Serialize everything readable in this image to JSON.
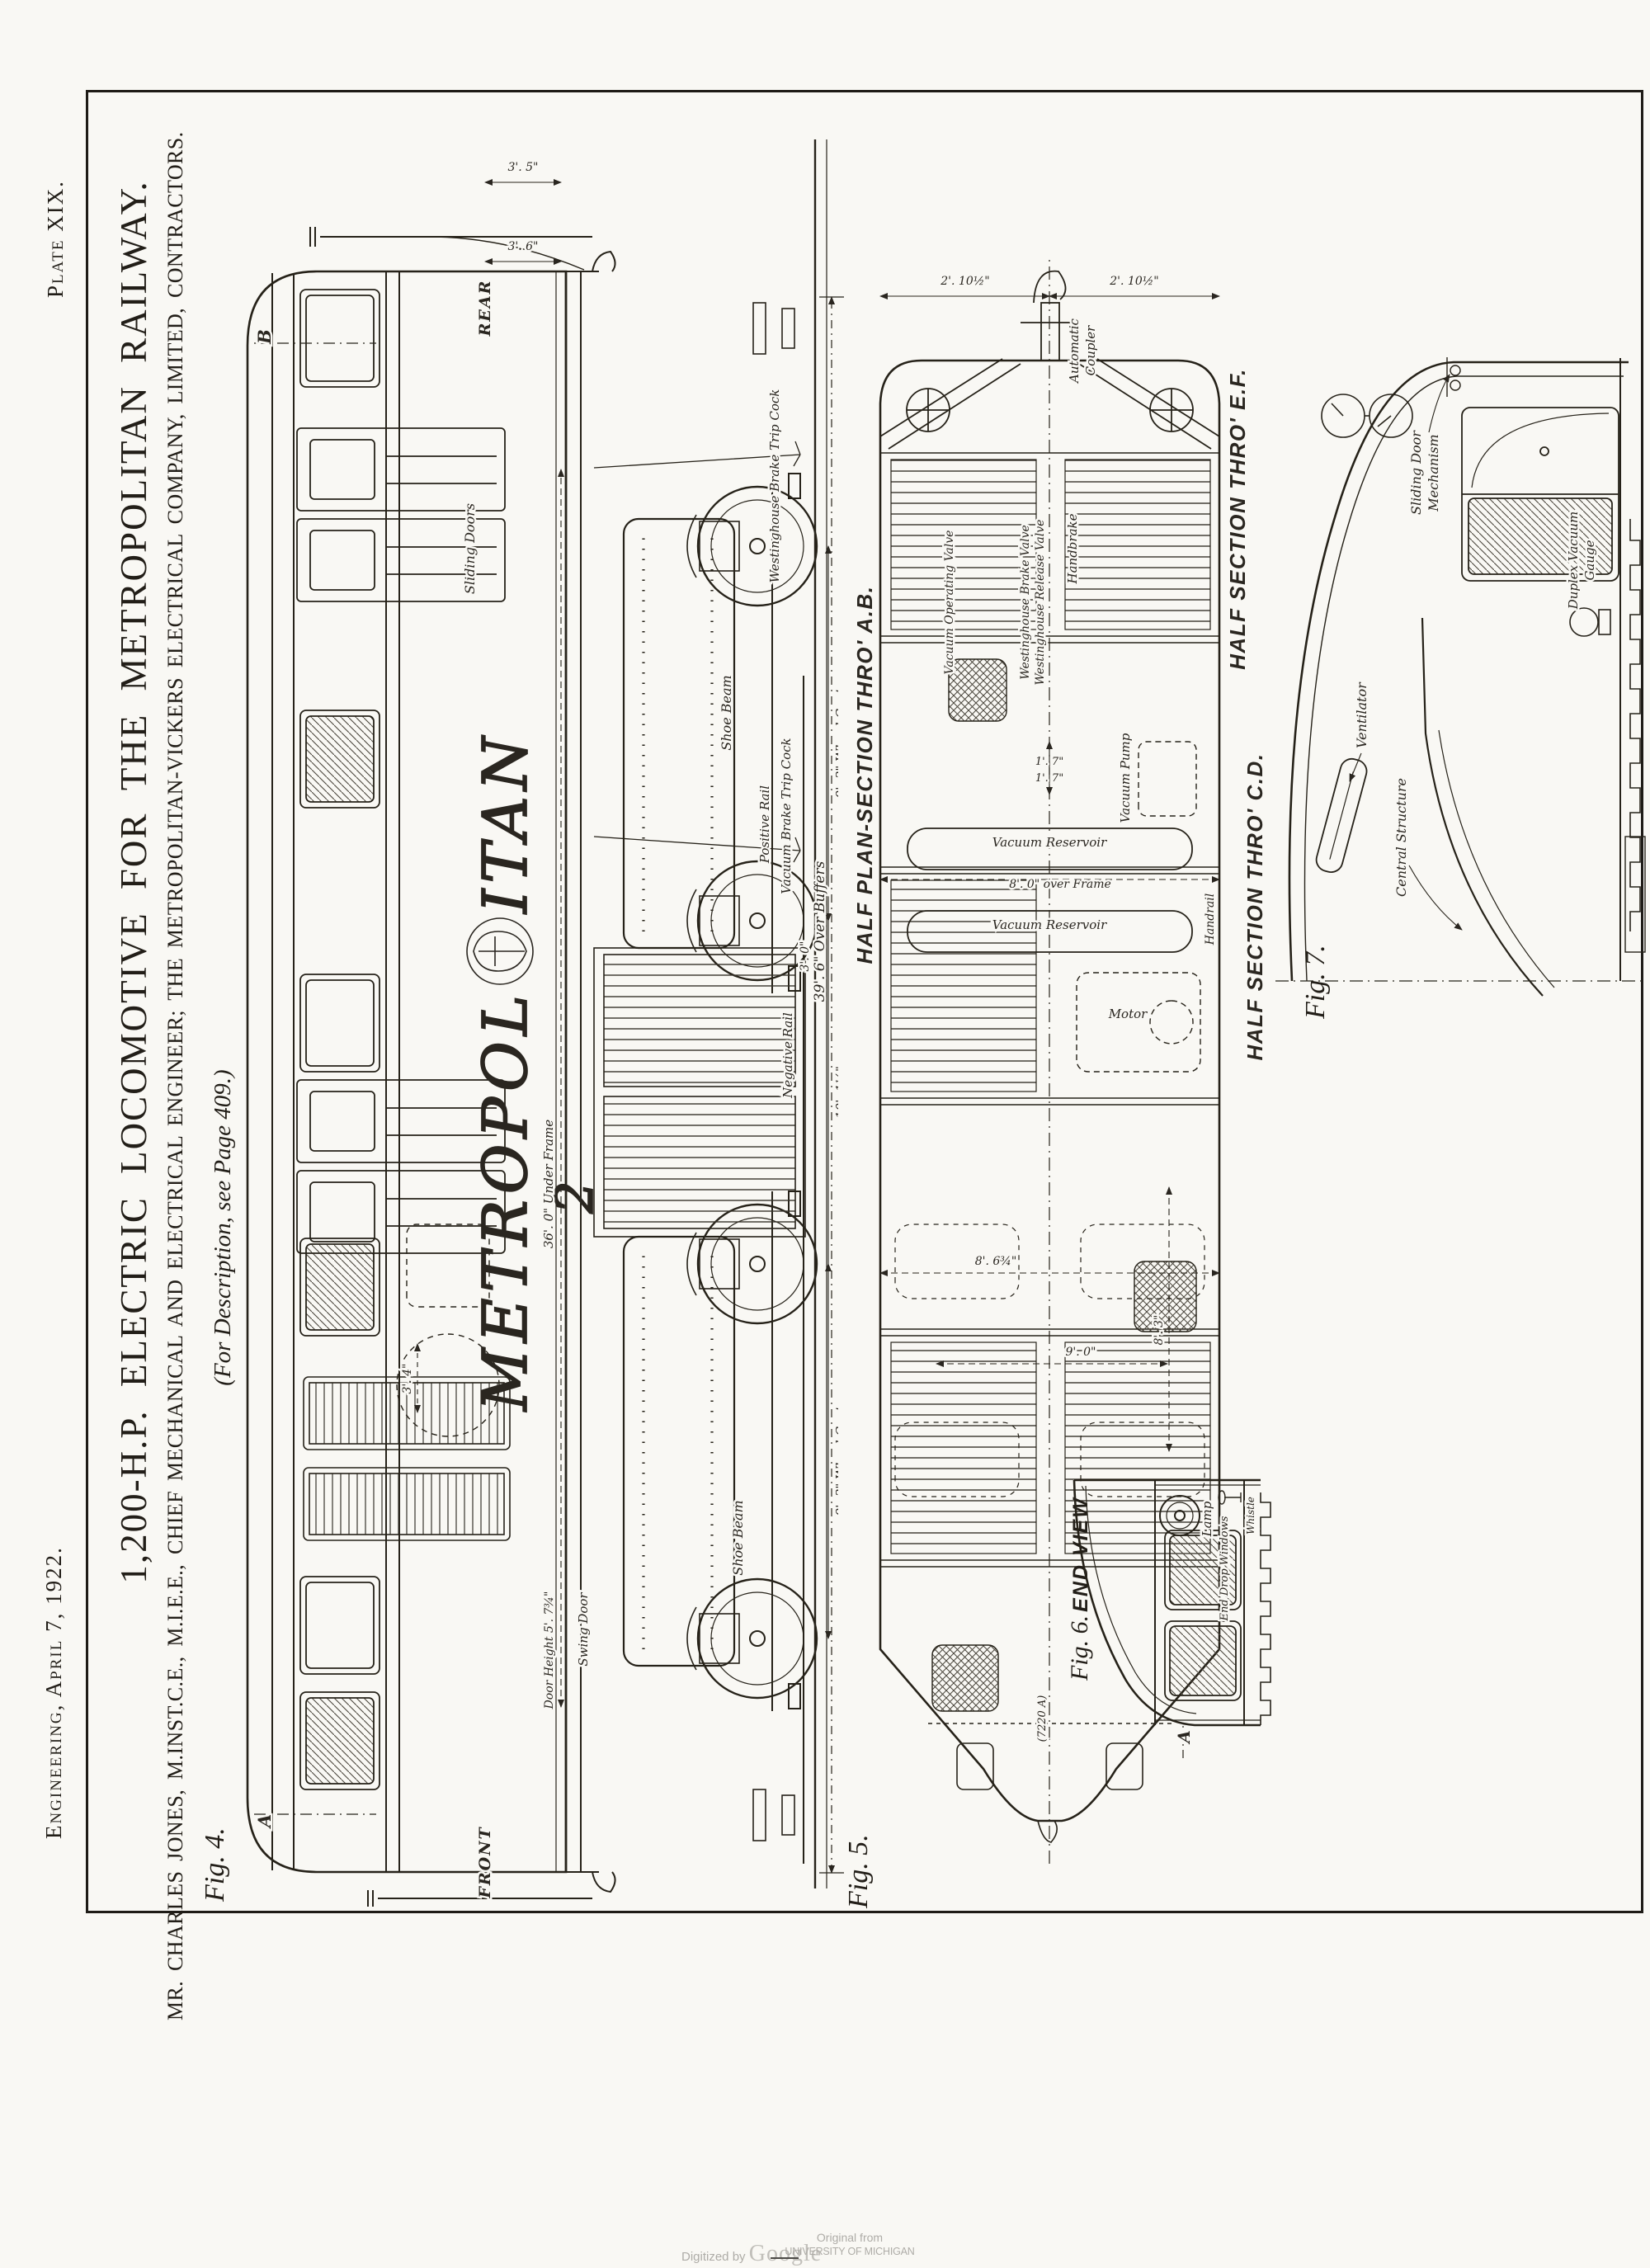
{
  "masthead": {
    "journal": "Engineering, April 7, 1922.",
    "plate": "Plate XIX."
  },
  "header": {
    "title": "1,200-H.P. ELECTRIC LOCOMOTIVE FOR THE METROPOLITAN RAILWAY.",
    "subtitle": "MR. CHARLES JONES, M.INST.C.E., M.I.E.E., CHIEF MECHANICAL AND ELECTRICAL ENGINEER; THE METROPOLITAN-VICKERS ELECTRICAL COMPANY, LIMITED, CONTRACTORS.",
    "note": "(For Description, see Page 409.)"
  },
  "fig4": {
    "caption": "Fig. 4.",
    "front": "FRONT",
    "rear": "REAR",
    "marker_a": "A",
    "marker_b": "B",
    "metropolitan_left": "METROPOL",
    "metropolitan_right": "ITAN",
    "loco_number": "2",
    "sliding_doors": "Sliding Doors",
    "swing_door": "Swing Door",
    "door_height": "Door Height 5'. 7¾\"",
    "under_frame": "36'. 0\" Under Frame",
    "shoe_beam": "Shoe Beam",
    "wheel_centres": "9'. 3\" Wheel Centres",
    "bogie_dim": "10'. 1¼\"",
    "dim_3_0": "3'. 0\"",
    "dim_3_4": "3'. 4\"",
    "dim_3_5": "3'. 5\"",
    "dim_3_6": "3'. 6\"",
    "positive_rail": "Positive Rail",
    "negative_rail": "Negative Rail",
    "westinghouse_trip": "Westinghouse Brake Trip Cock",
    "vacuum_trip": "Vacuum Brake Trip Cock"
  },
  "fig5": {
    "caption": "Fig. 5.",
    "over_buffers": "39'. 6\" Over Buffers",
    "title_ab": "HALF PLAN-SECTION THRO' A.B.",
    "title_ef": "HALF SECTION THRO' E.F.",
    "title_cd": "HALF SECTION THRO' C.D.",
    "coupler_line1": "Automatic",
    "coupler_line2": "Coupler",
    "dim_2_10": "2'. 10½\"",
    "dim_1_7": "1'. 7\"",
    "dim_8_6": "8'. 6¾\"",
    "dim_9_0": "9'. 0\"",
    "dim_8_3": "8'. 3\"",
    "dim_8_0": "8'. 0\" over Frame",
    "vacuum_reservoir": "Vacuum Reservoir",
    "motor": "Motor",
    "vacuum_pump": "Vacuum Pump",
    "handrail": "Handrail",
    "handbrake": "Handbrake",
    "westinghouse_brake_valve": "Westinghouse Brake Valve",
    "westinghouse_release_valve": "Westinghouse Release Valve",
    "vacuum_operating_valve": "Vacuum Operating Valve",
    "drawing_no": "(7220 A)"
  },
  "fig6": {
    "caption": "Fig. 6.",
    "end_view": "END VIEW",
    "end_drop_windows": "End Drop Windows",
    "lamp": "Lamp",
    "whistle": "Whistle",
    "marker_a": "A"
  },
  "fig7": {
    "caption": "Fig. 7.",
    "sliding_door_line1": "Sliding Door",
    "sliding_door_line2": "Mechanism",
    "ventilator": "Ventilator",
    "central_structure": "Central Structure",
    "duplex_line1": "Duplex Vacuum",
    "duplex_line2": "Gauge"
  },
  "footer": {
    "digitized_by": "Digitized by",
    "google": "Google",
    "original_from": "Original from",
    "university": "UNIVERSITY OF MICHIGAN"
  }
}
